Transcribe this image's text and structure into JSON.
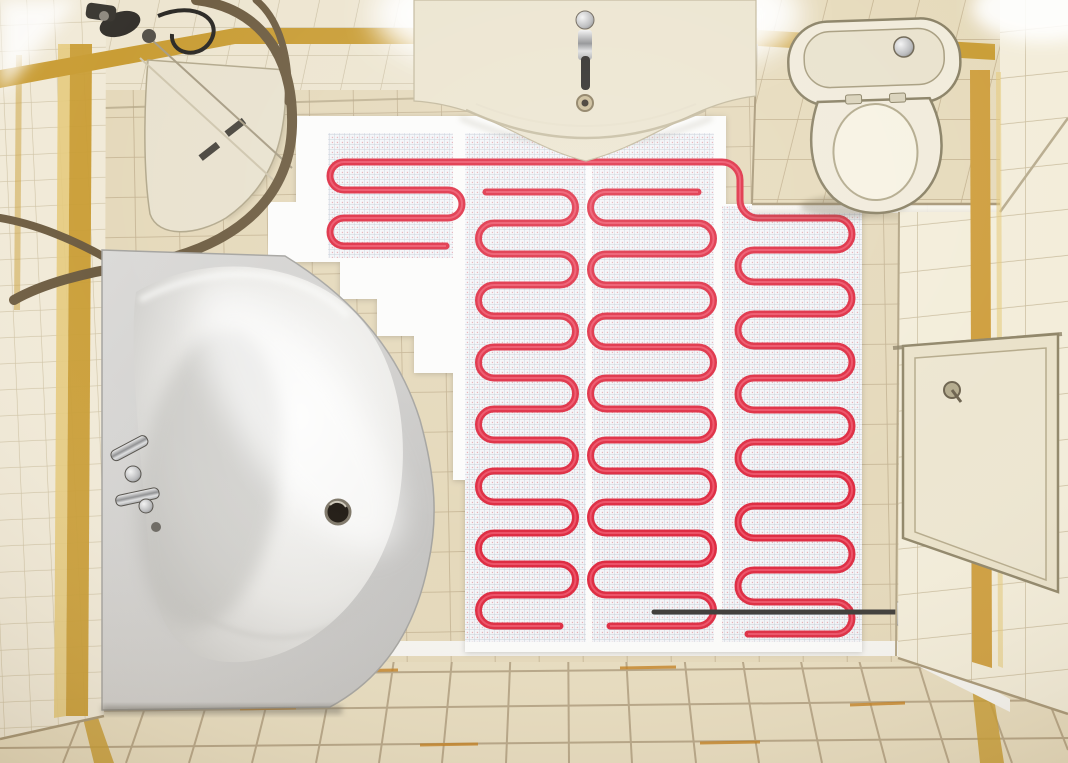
{
  "scene": {
    "subject": "Top-down view of a small bathroom with an electric underfloor heating cable mat installed on the open floor",
    "view": "overhead 3D render",
    "visible_text": "none"
  },
  "objects": {
    "heating_mat": {
      "label": "electric heating mat",
      "strips": 4,
      "cable_pattern": "serpentine loops",
      "mesh": "fine grid backing"
    },
    "bathtub": "corner bathtub with chrome faucet and drain",
    "shower": "quadrant shower enclosure with curved bronze rail and tray",
    "vanity": "wall-hung washbasin vanity with chrome faucet",
    "toilet": "close-coupled toilet on tiled platform",
    "access_panel": "wall access hatch with knob",
    "sensor_conduit": "floor sensor conduit running to wall plate",
    "walls": "beige ceramic tile with gold accent stripes",
    "floor": "beige ceramic floor tiles"
  },
  "colors": {
    "gold_accent": "#c99d35",
    "gold_light": "#e6cb7e",
    "heating_cable": "#de2c42",
    "heating_cable_highlight": "#f26177",
    "sensor_conduit": "#3d3b38",
    "mat_underlay": "#fcfcfb",
    "access_panel": "#eae2ca",
    "sanitary_ceramic": "#f1ebdb",
    "vanity_ceramic": "#ece5d0",
    "shower_tray": "#e9e2cf",
    "shower_rail": "#6f5e43",
    "wall_tile": "#f0e9d7",
    "floor_tile": "#e8ddc0",
    "tub_shell": "#d5d4d2"
  }
}
